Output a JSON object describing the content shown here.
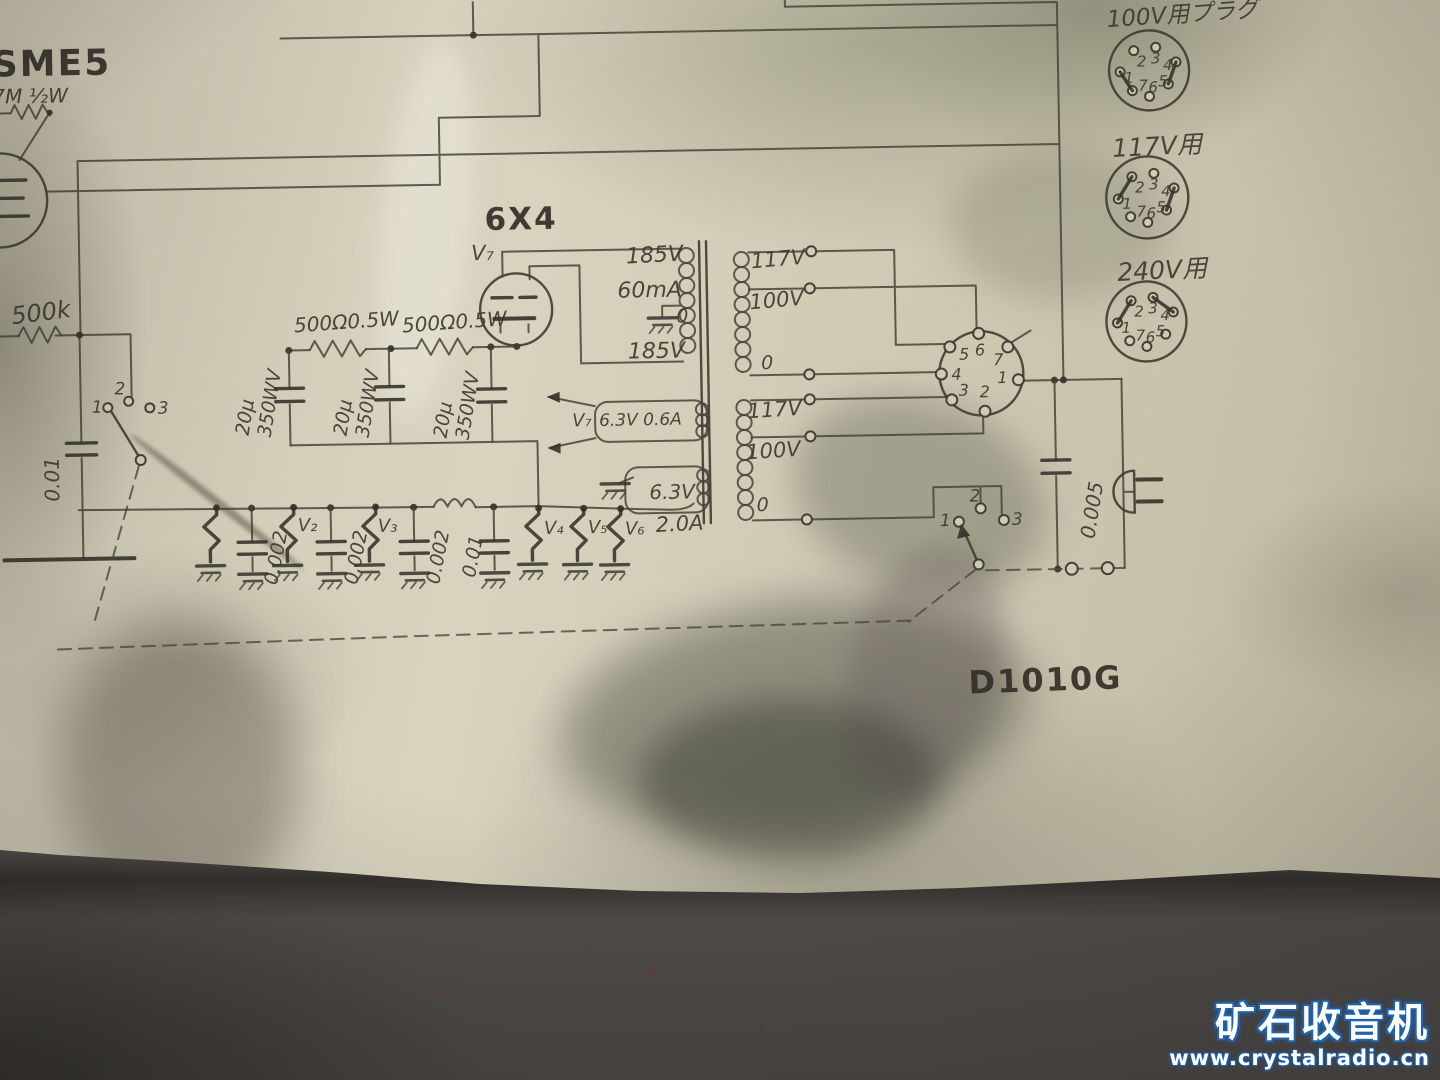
{
  "schematic": {
    "model_label": "D1010G",
    "input_stage": {
      "tube_label": "SME5",
      "grid_resistor": "7M ½W",
      "volume_pot": "500k",
      "coupling_cap": "0.01",
      "switch_contacts": [
        "1",
        "2",
        "3"
      ]
    },
    "rectifier": {
      "type": "6X4",
      "ref": "V₇"
    },
    "b_plus": {
      "dropper_resistors": [
        "500Ω0.5W",
        "500Ω0.5W"
      ],
      "filter_caps": [
        {
          "value": "20μ",
          "rating": "350WV"
        },
        {
          "value": "20μ",
          "rating": "350WV"
        },
        {
          "value": "20μ",
          "rating": "350WV"
        }
      ]
    },
    "transformer": {
      "hv_top": "185V",
      "hv_current": "60mA",
      "hv_tap": "0",
      "hv_bottom": "185V",
      "heater_v7_ref": "V₇",
      "heater_v7_rating": "6.3V 0.6A",
      "heater_rating": "6.3V",
      "heater_current": "2.0A",
      "primary_upper": {
        "tap_117": "117V",
        "tap_100": "100V",
        "tap_0": "0"
      },
      "primary_lower": {
        "tap_117": "117V",
        "tap_100": "100V",
        "tap_0": "0"
      }
    },
    "selector_pins": [
      "1",
      "2",
      "3",
      "4",
      "5",
      "6",
      "7"
    ],
    "plugs": [
      {
        "label": "100V用プラグ",
        "pins": [
          "1",
          "2",
          "3",
          "4",
          "5",
          "6",
          "7"
        ]
      },
      {
        "label": "117V用",
        "pins": [
          "1",
          "2",
          "3",
          "4",
          "5",
          "6",
          "7"
        ]
      },
      {
        "label": "240V用",
        "pins": [
          "1",
          "2",
          "3",
          "4",
          "5",
          "6",
          "7"
        ]
      }
    ],
    "heater_line": {
      "tube_refs": [
        "V₂",
        "V₃",
        "V₄",
        "V₅",
        "V₆"
      ],
      "bypass_caps": [
        "0.002",
        "0.002",
        "0.002"
      ],
      "filter_cap": "0.01",
      "line_cap": "0.005",
      "switch_contacts": [
        "1",
        "2",
        "3"
      ]
    }
  },
  "watermark": {
    "title": "矿石收音机",
    "url": "www.crystalradio.cn"
  }
}
